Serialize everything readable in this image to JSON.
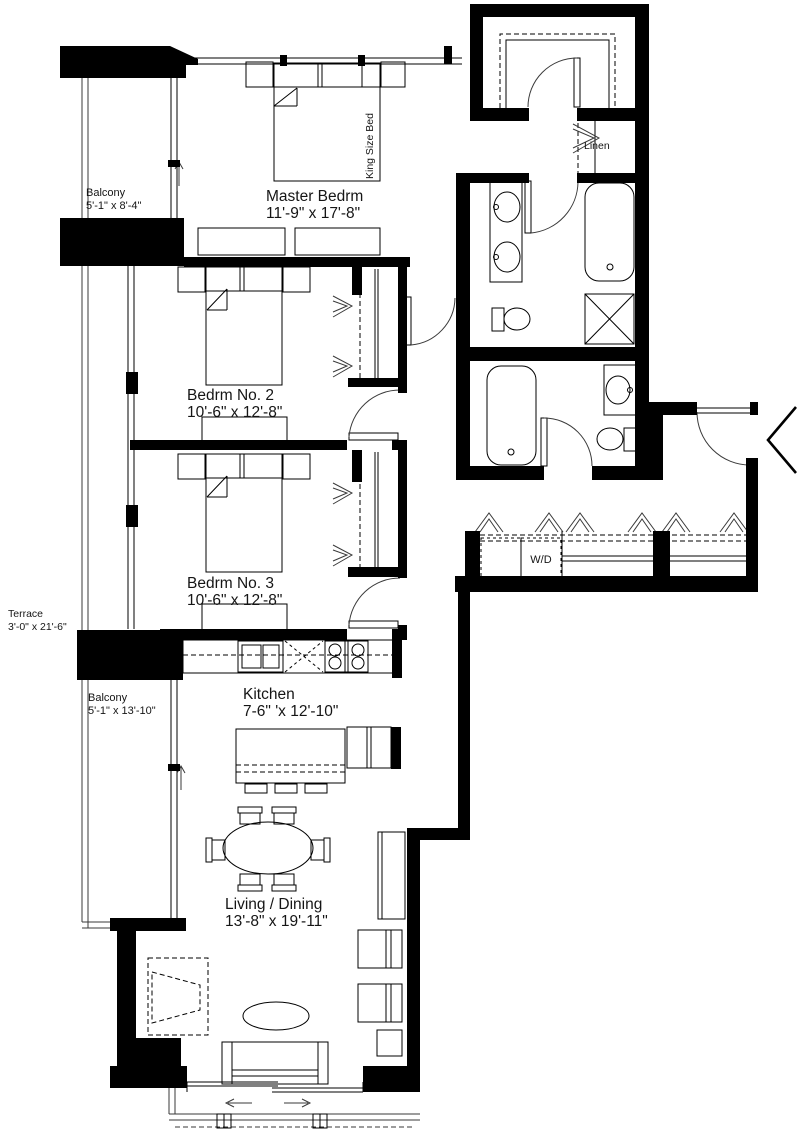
{
  "colors": {
    "wall": "#000000",
    "line": "#000000",
    "background": "#ffffff"
  },
  "labels": {
    "balcony_top": {
      "name": "Balcony",
      "dims": "5'-1\" x 8'-4\""
    },
    "master_bedroom": {
      "name": "Master Bedrm",
      "dims": "11'-9\" x 17'-8\"",
      "bed": "King Size Bed"
    },
    "linen": {
      "name": "Linen"
    },
    "bedroom_2": {
      "name": "Bedrm No. 2",
      "dims": "10'-6\" x 12'-8\""
    },
    "bedroom_3": {
      "name": "Bedrm No. 3",
      "dims": "10'-6\" x 12'-8\""
    },
    "terrace": {
      "name": "Terrace",
      "dims": "3'-0\" x 21'-6\""
    },
    "balcony_lower": {
      "name": "Balcony",
      "dims": "5'-1\" x 13'-10\""
    },
    "kitchen": {
      "name": "Kitchen",
      "dims": "7-6\" 'x 12'-10\""
    },
    "laundry": {
      "name": "W/D"
    },
    "living_dining": {
      "name": "Living / Dining",
      "dims": "13'-8\" x 19'-11\""
    }
  }
}
